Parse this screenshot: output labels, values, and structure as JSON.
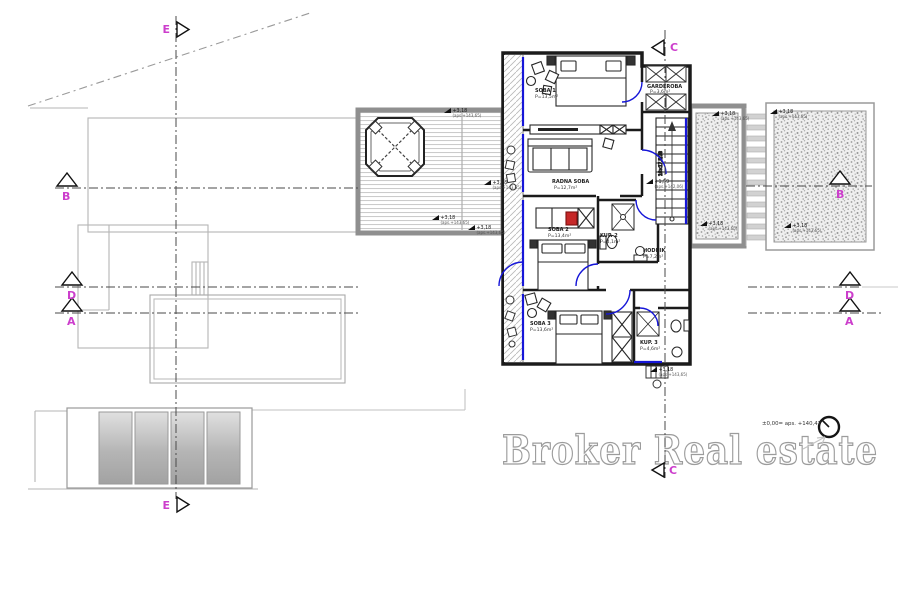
{
  "watermark": {
    "text": "Broker Real estate"
  },
  "annotations": {
    "elevation_note": "±0,00= aps. +140,47",
    "stair_note": "16×17,5/28"
  },
  "section_markers": {
    "e_top": "E",
    "e_bottom": "E",
    "c_top": "C",
    "c_bottom": "C",
    "b_left": "B",
    "b_right": "B",
    "d_left": "D",
    "d_right": "D",
    "a_left": "A",
    "a_right": "A"
  },
  "rooms": [
    {
      "name": "SOBA 1",
      "area": "P=13,5m²"
    },
    {
      "name": "GARDEROBA",
      "area": "P=3,6m²"
    },
    {
      "name": "RADNA SOBA",
      "area": "P=12,7m²"
    },
    {
      "name": "SOBA 2",
      "area": "P=13,4m²"
    },
    {
      "name": "KUP. 2",
      "area": "P=4,1m²"
    },
    {
      "name": "HODNIK",
      "area": "P=7,2m²"
    },
    {
      "name": "SOBA 3",
      "area": "P=13,6m²"
    },
    {
      "name": "KUP. 3",
      "area": "P=4,6m²"
    }
  ],
  "spot_elevations": [
    {
      "x": 444,
      "y": 113,
      "value": "+3,18",
      "datum": "(aps.+143,65)"
    },
    {
      "x": 484,
      "y": 185,
      "value": "+3,18",
      "datum": "(aps.+143,65)"
    },
    {
      "x": 432,
      "y": 220,
      "value": "+3,18",
      "datum": "(aps.+143,65)"
    },
    {
      "x": 468,
      "y": 230,
      "value": "+3,18",
      "datum": "(aps.+143,65)"
    },
    {
      "x": 712,
      "y": 116,
      "value": "+3,18",
      "datum": "(aps.+143,65)"
    },
    {
      "x": 770,
      "y": 114,
      "value": "+3,18",
      "datum": "(aps.+143,65)"
    },
    {
      "x": 700,
      "y": 226,
      "value": "+3,18",
      "datum": "(aps.+143,65)"
    },
    {
      "x": 784,
      "y": 228,
      "value": "+3,18",
      "datum": "(aps.+143,65)"
    },
    {
      "x": 646,
      "y": 184,
      "value": "+1,59",
      "datum": "(aps.+142,06)"
    },
    {
      "x": 650,
      "y": 372,
      "value": "+3,18",
      "datum": "(aps.+143,65)"
    }
  ],
  "colors": {
    "accent_blue": "#1616d8",
    "section_magenta": "#cc3ecc",
    "watermark_gray": "#9c9c9c"
  }
}
